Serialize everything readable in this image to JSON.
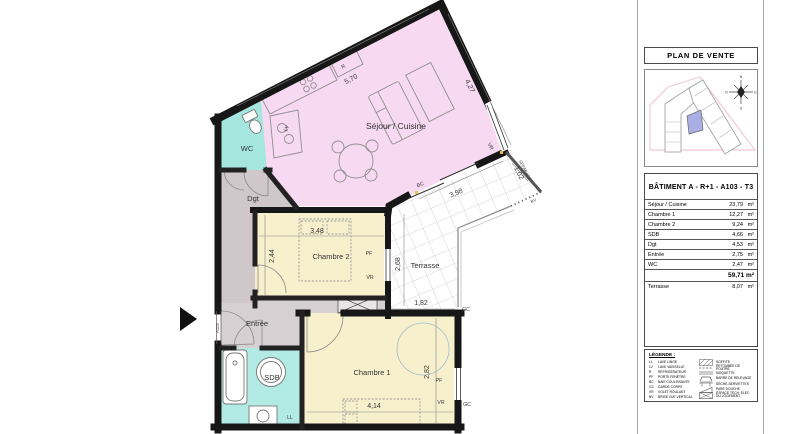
{
  "plan": {
    "rooms": {
      "sejour": "Séjour / Cuisine",
      "wc": "WC",
      "dgt": "Dgt",
      "chambre2": "Chambre 2",
      "terrasse": "Terrasse",
      "entree": "Entrée",
      "sdb": "SDB",
      "chambre1": "Chambre 1"
    },
    "dims": {
      "sejour_w": "5,70",
      "sejour_h": "4,27",
      "separatif_l": "1,02",
      "bc_w": "3,98",
      "ch2_w": "3,48",
      "ch2_h": "2,44",
      "terrasse_h": "2,68",
      "terrasse_w": "1,82",
      "ch1_w": "4,14",
      "ch1_h": "2,82"
    },
    "codes": {
      "fridge": "R",
      "dishwasher": "LV",
      "shutter": "VR",
      "sliding_door": "BC",
      "window": "PF",
      "guardrail": "GC",
      "washer": "LL",
      "screen": "BV",
      "separator": "SEPARATIF",
      "unit": "A103"
    }
  },
  "panel": {
    "title": "PLAN DE VENTE",
    "building_title": "BÂTIMENT A - R+1 - A103 - T3",
    "areas": {
      "rows": [
        {
          "label": "Séjour / Cuisine",
          "value": "23,79",
          "unit": "m²"
        },
        {
          "label": "Chambre 1",
          "value": "12,27",
          "unit": "m²"
        },
        {
          "label": "Chambre 2",
          "value": "9,24",
          "unit": "m²"
        },
        {
          "label": "SDB",
          "value": "4,66",
          "unit": "m²"
        },
        {
          "label": "Dgt",
          "value": "4,53",
          "unit": "m²"
        },
        {
          "label": "Entrée",
          "value": "2,75",
          "unit": "m²"
        },
        {
          "label": "WC",
          "value": "2,47",
          "unit": "m²"
        }
      ],
      "total": "59,71 m²",
      "terrasse": {
        "label": "Terrasse",
        "value": "8,07",
        "unit": "m²"
      }
    },
    "site": {
      "compass": {
        "n": "N",
        "e": "E",
        "s": "S",
        "o": "O"
      }
    },
    "legend": {
      "title": "LÉGENDE :",
      "codes": [
        {
          "code": "LL",
          "label": "LAVE LINGE"
        },
        {
          "code": "LV",
          "label": "LAVE VAISSELLE"
        },
        {
          "code": "R",
          "label": "RÉFRIGÉRATEUR"
        },
        {
          "code": "PF",
          "label": "PORTE FENÊTRE"
        },
        {
          "code": "BC",
          "label": "BAIE COULISSANTE"
        },
        {
          "code": "GC",
          "label": "GARDE CORPS"
        },
        {
          "code": "VR",
          "label": "VOLET ROULANT"
        },
        {
          "code": "BV",
          "label": "BRISE VUE VERTICAL"
        }
      ],
      "symbols": [
        {
          "icon": "soffite-hatch-icon",
          "label": "SOFFITE"
        },
        {
          "icon": "beam-dashed-icon",
          "label": "RETOMBÉE DE POUTRE"
        },
        {
          "icon": "carpet-icon",
          "label": "MOQUETTE"
        },
        {
          "icon": "grab-bar-icon",
          "label": "BARRE DE RELEVAGE"
        },
        {
          "icon": "towel-dryer-icon",
          "label": "SÈCHE-SERVIETTES"
        },
        {
          "icon": "shower-screen-icon",
          "label": "PARE DOUCHE"
        },
        {
          "icon": "elec-space-icon",
          "label": "ESPACE TECH. ÉLEC DU LOGEMENT"
        }
      ]
    }
  },
  "colors": {
    "sejour": "#f8d9f2",
    "wc": "#a5e6de",
    "sdb": "#b2ebe3",
    "bedroom": "#f6f0cd",
    "hall": "#cfc7c9",
    "entree": "#d6d0d2",
    "wall": "#171717",
    "unit_highlight": "#a9afe4"
  }
}
